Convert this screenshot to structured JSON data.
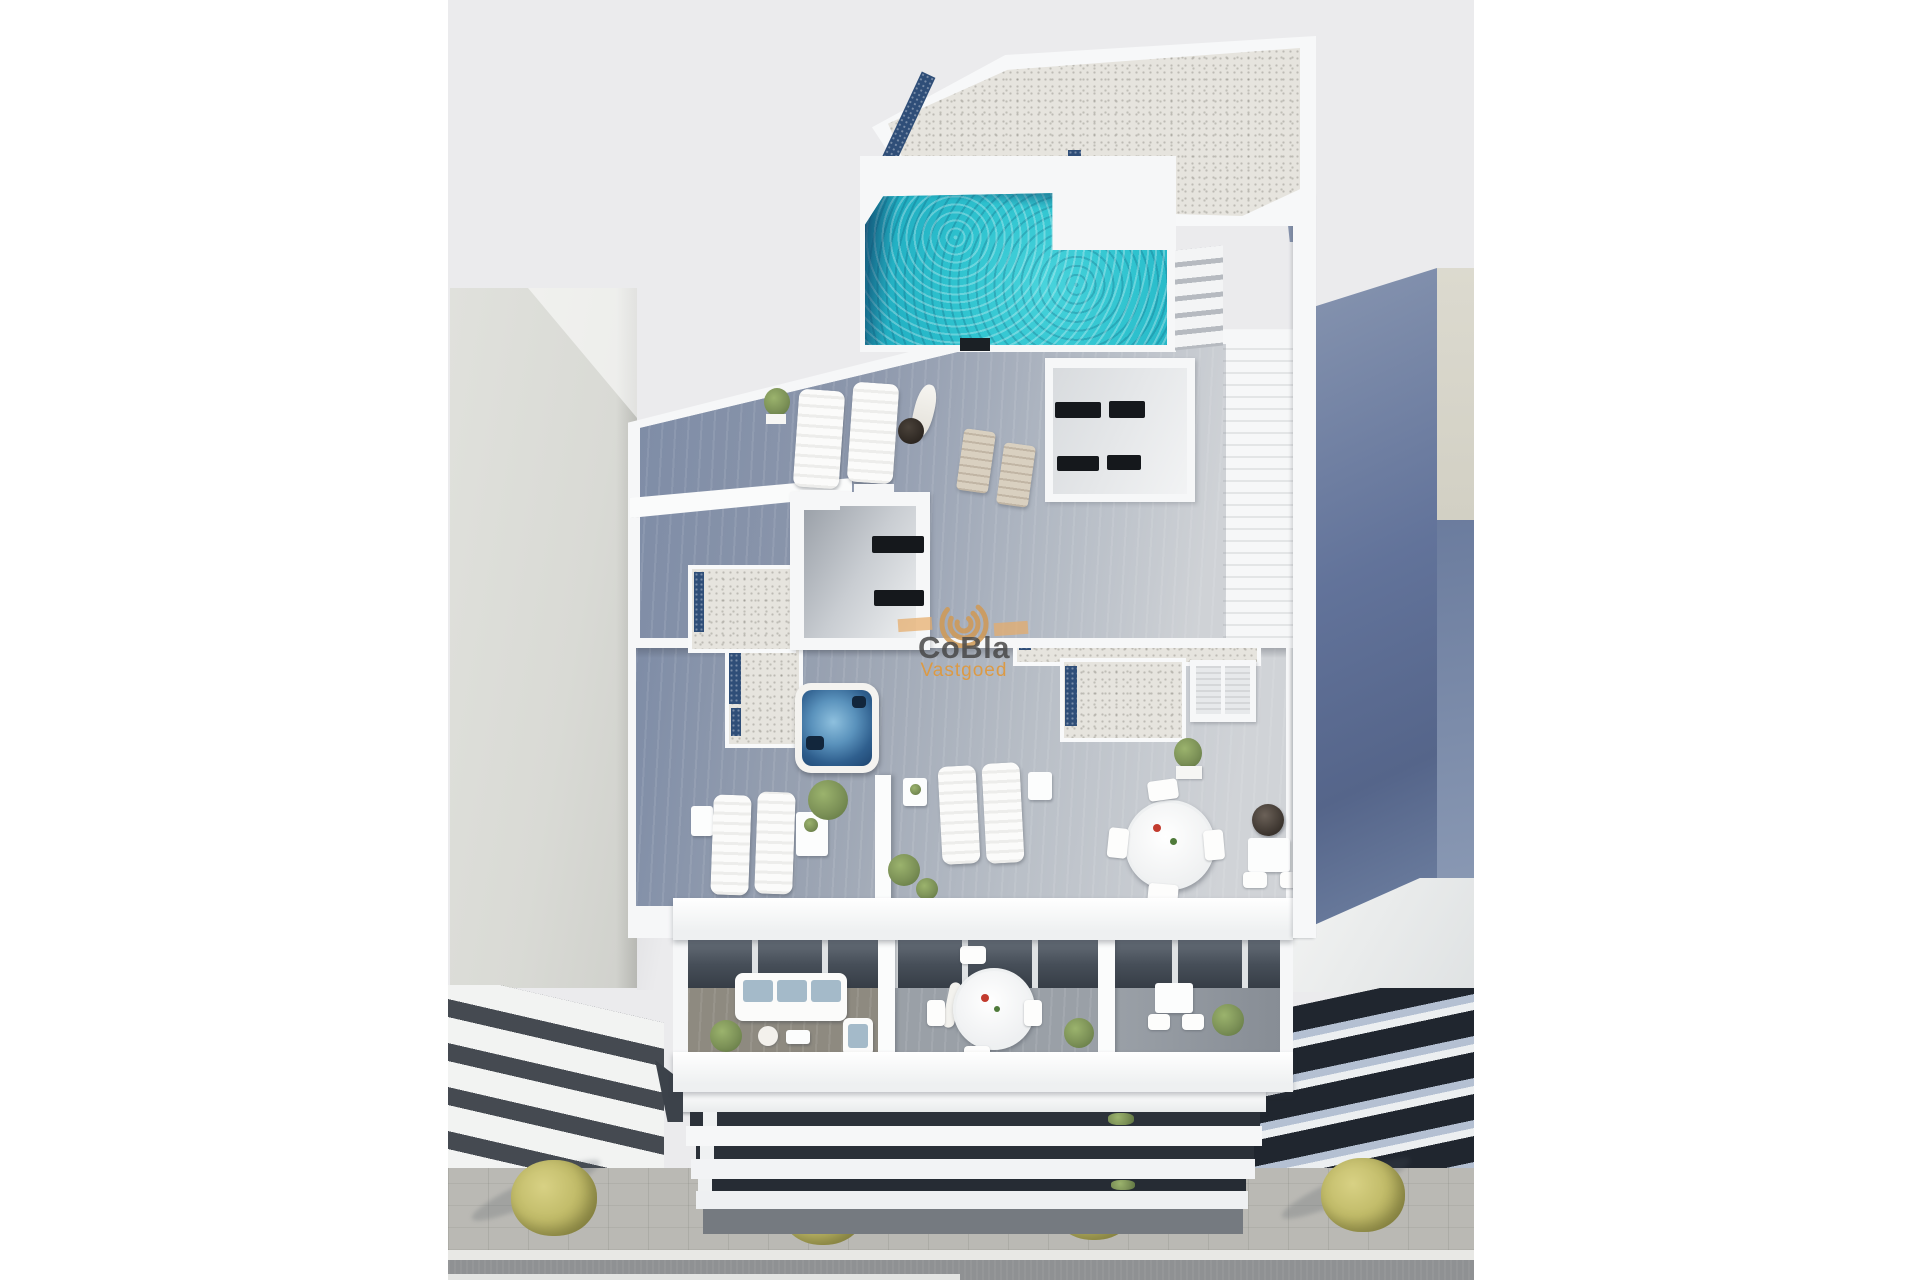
{
  "scene": {
    "type": "architectural-3d-render",
    "description": "Aerial 3D render of a modern white apartment building with rooftop pool, wooden sun terraces, jacuzzi, balconies and street frontage, flanked by neighbouring buildings"
  },
  "watermark": {
    "title": "CoBla",
    "subtitle": "Vastgoed",
    "logo": "spiral-icon"
  },
  "colors": {
    "page": "#ffffff",
    "bg": "#ebebed",
    "white-structure": "#f6f7f8",
    "pool-water": "#2fc3cf",
    "pool-deep": "#14537d",
    "deck-dark": "#7e8ca6",
    "deck-light": "#d0d3d7",
    "gravel": "#e6e4de",
    "gravel-blue": "#2f4e78",
    "jacuzzi-water": "#2f5f8e",
    "neighbor-left": "#d9dad5",
    "neighbor-right": "#62739a",
    "neighbor-right-dark": "#20262f",
    "glazing": "#474f59",
    "facade-gap": "#2c323a",
    "greenery": "#7c9157",
    "street-tree": "#c2bc6a",
    "sidewalk": "#bab9b4",
    "road": "#8f9193",
    "cushion": "#a4bac9",
    "watermark-text": "rgba(72,72,72,0.85)",
    "watermark-orange": "#df993e"
  }
}
